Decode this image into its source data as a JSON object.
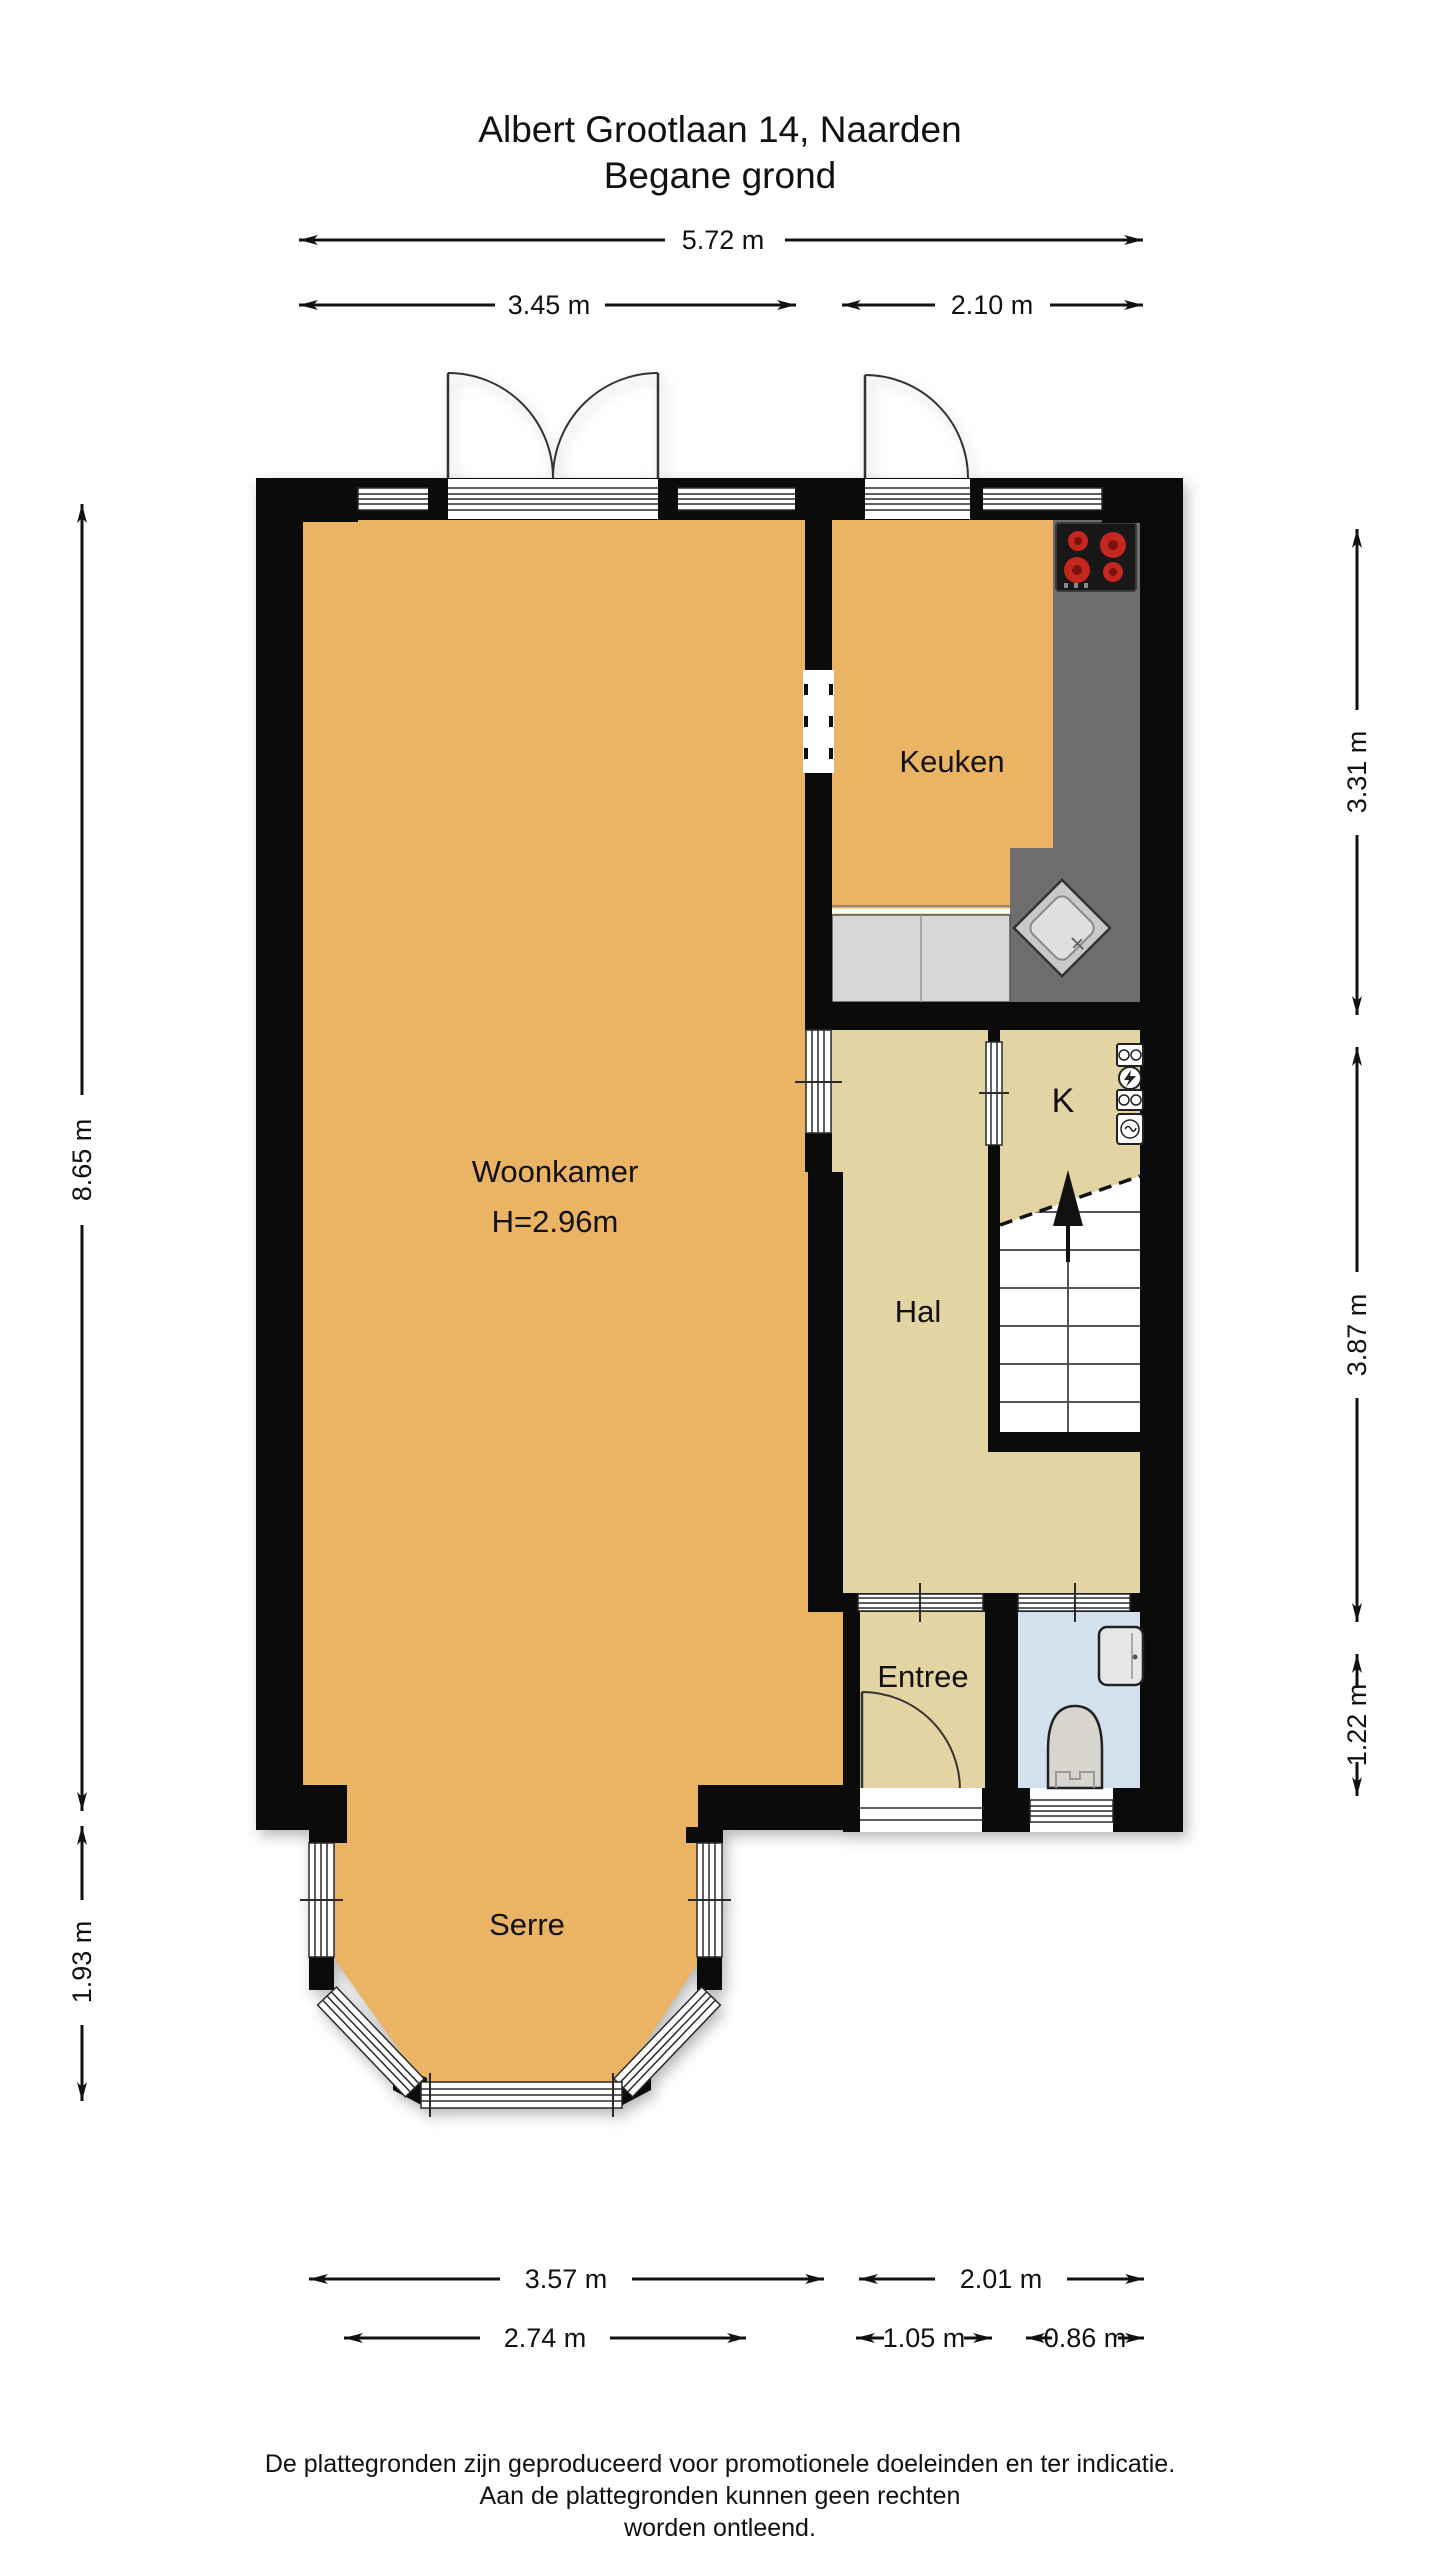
{
  "title": {
    "line1": "Albert Grootlaan 14, Naarden",
    "line2": "Begane grond"
  },
  "rooms": {
    "woonkamer": {
      "label": "Woonkamer",
      "height_label": "H=2.96m"
    },
    "keuken": {
      "label": "Keuken"
    },
    "kast": {
      "label": "K"
    },
    "hal": {
      "label": "Hal"
    },
    "entree": {
      "label": "Entree"
    },
    "serre": {
      "label": "Serre"
    }
  },
  "dims": {
    "top_total": "5.72 m",
    "top_left": "3.45 m",
    "top_right": "2.10 m",
    "left_main": "8.65 m",
    "left_serre": "1.93 m",
    "right_kitchen": "3.31 m",
    "right_hall": "3.87 m",
    "right_entree": "1.22 m",
    "bottom_left": "3.57 m",
    "bottom_right": "2.01 m",
    "bottom_serre": "2.74 m",
    "bottom_entree": "1.05 m",
    "bottom_toilet": "0.86 m"
  },
  "footer": {
    "line1": "De plattegronden zijn geproduceerd voor promotionele doeleinden en ter indicatie.",
    "line2": "Aan de plattegronden kunnen geen rechten",
    "line3": "worden ontleend."
  },
  "colors": {
    "floor_main": "#EBB464",
    "floor_hall": "#E3D4A3",
    "floor_toilet": "#D3E1EE",
    "counter_light": "#D8D8D8",
    "counter_dark": "#6E6E6E",
    "wall": "#0B0B0B",
    "burner_red": "#C4271D"
  }
}
